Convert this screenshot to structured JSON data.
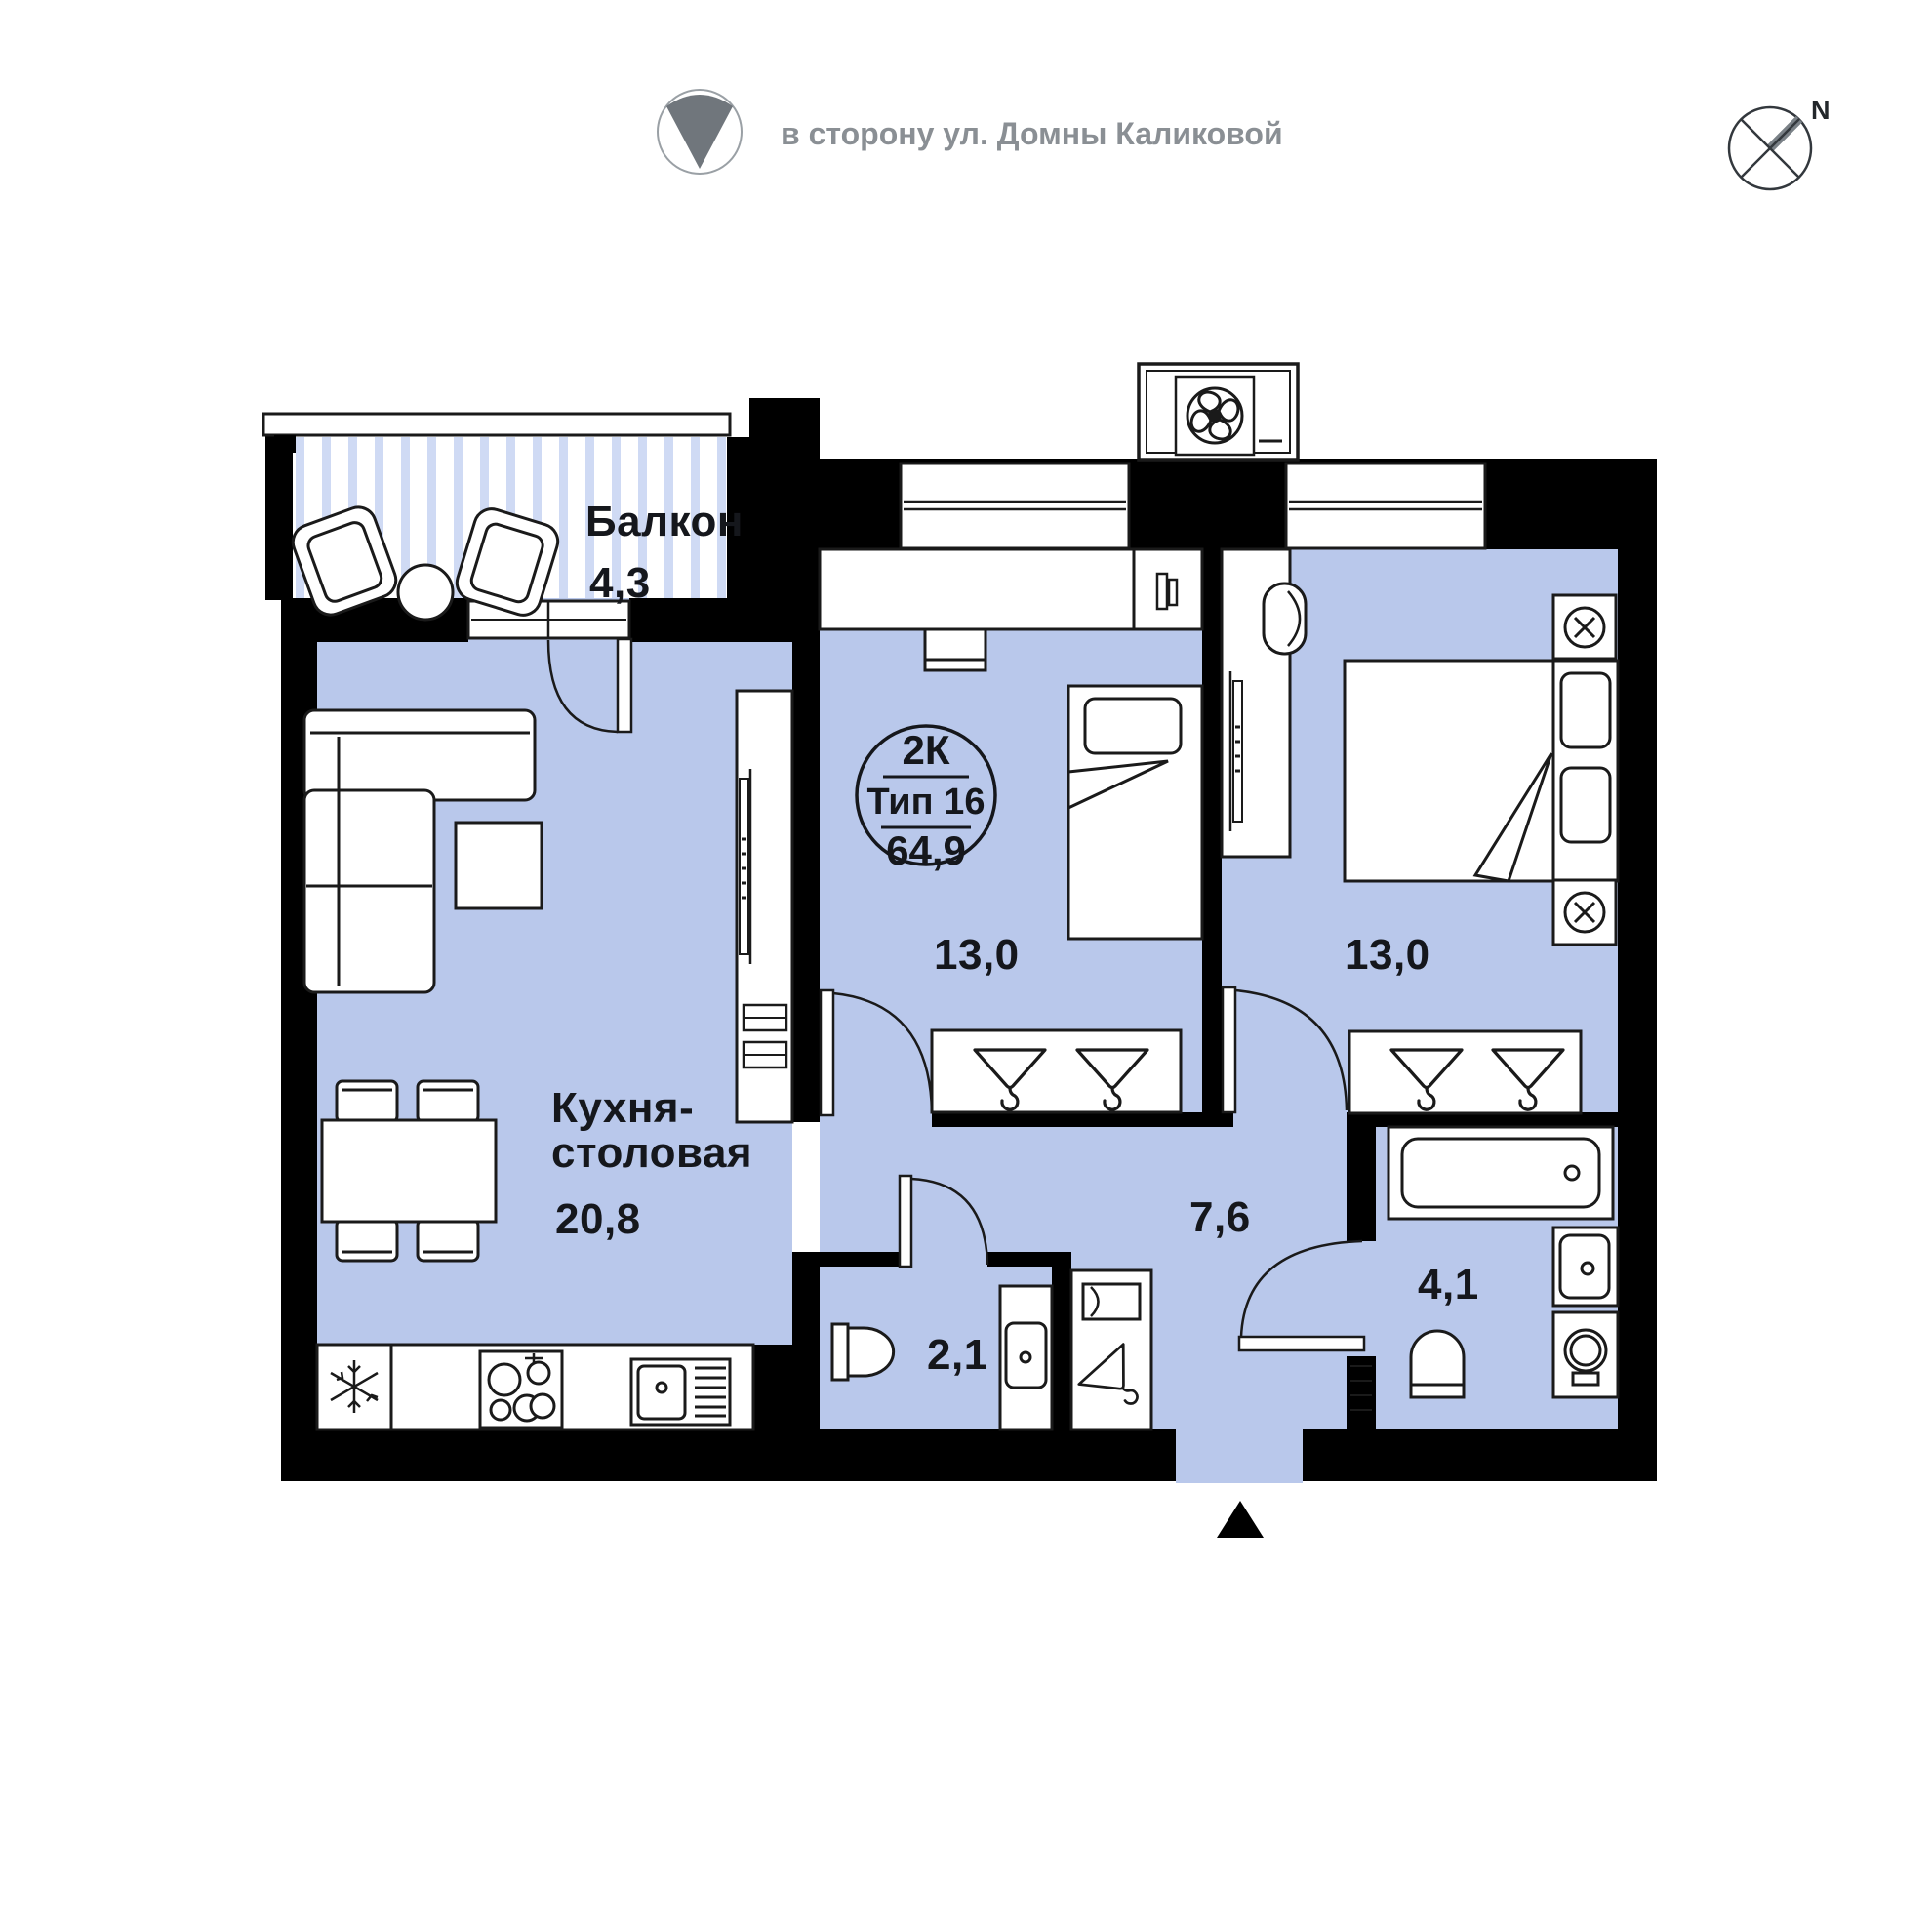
{
  "header": {
    "direction_text": "в сторону ул. Домны Каликовой",
    "compass_n": "N"
  },
  "badge": {
    "rooms": "2К",
    "type": "Тип 16",
    "area": "64,9"
  },
  "rooms": {
    "balcony": {
      "name": "Балкон",
      "area": "4,3"
    },
    "kitchen": {
      "name_line1": "Кухня-",
      "name_line2": "столовая",
      "area": "20,8"
    },
    "bedroom1": {
      "area": "13,0"
    },
    "bedroom2": {
      "area": "13,0"
    },
    "hallway": {
      "area": "7,6"
    },
    "wc": {
      "area": "2,1"
    },
    "bathroom": {
      "area": "4,1"
    }
  },
  "colors": {
    "floor": "#b9c8eb",
    "balcony_stripe": "#cfdaf4",
    "wall": "#000000",
    "furniture_line": "#1a1a1a",
    "label_text": "#15171c",
    "header_gray": "#8a8f94",
    "direction_wedge": "#70767c",
    "compass_arm": "#7a8187"
  },
  "icons": [
    "direction-indicator-icon",
    "compass-icon",
    "entrance-arrow-icon",
    "ac-fan-unit-icon",
    "snowflake-fridge-icon",
    "stove-burners-icon",
    "kitchen-sink-icon",
    "hanger-icon",
    "sconce-lamp-icon",
    "mirror-icon",
    "coat-hook-icon",
    "bathtub-icon",
    "washing-machine-icon",
    "toilet-icon",
    "washbasin-icon",
    "radiator-icon",
    "tv-icon"
  ]
}
